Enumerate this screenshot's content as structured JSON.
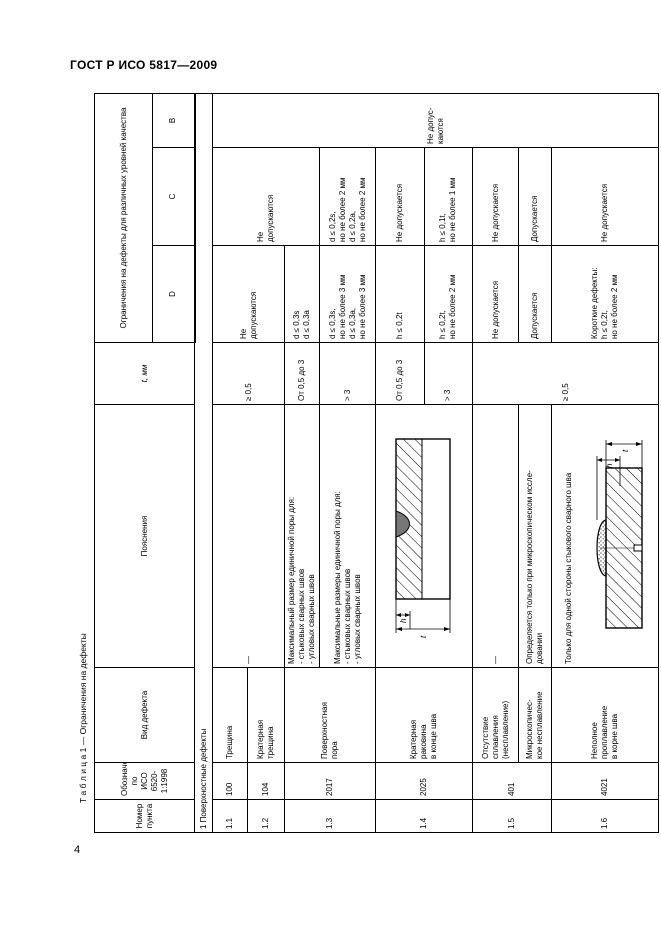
{
  "page": {
    "doc_code": "ГОСТ Р ИСО 5817—2009",
    "page_number": "4",
    "colors": {
      "text": "#000000",
      "background": "#ffffff",
      "border": "#000000",
      "crater_fill": "#777777"
    }
  },
  "caption": "Т а б л и ц а  1 — Ограничения на дефекты",
  "headers": {
    "num": "Номер\nпункта",
    "ref": "Обозначение по\nИСО 6520-1:1998",
    "type": "Вид дефекта",
    "note": "Пояснения",
    "t": "t, мм",
    "limits": "Ограничения на дефекты для различных уровней качества",
    "level_d": "D",
    "level_c": "C",
    "level_b": "B"
  },
  "section1": "1 Поверхностные дефекты",
  "cells": {
    "r11_num": "1.1",
    "r11_ref": "100",
    "r11_type": "Трещина",
    "r12_num": "1.2",
    "r12_ref": "104",
    "r12_type": "Кратерная\nтрещина",
    "r11_12_note": "—",
    "r11_12_t": "≥ 0,5",
    "r11_12_d": "Не\nдопускаются",
    "c_merge_11_13a": "Не\nдопускаются",
    "b_merge_all": "Не допус-каются",
    "r13_num": "1.3",
    "r13_ref": "2017",
    "r13_type": "Поверхностная\nпора",
    "r13a_note": "Максимальный размер единичной поры для:\n- стыковых сварных швов\n- угловых сварных швов",
    "r13a_t": "От 0,5 до 3",
    "r13a_d": "d ≤ 0,3s\nd ≤ 0,3a",
    "r13b_note": "Максимальные размеры единичной поры для:\n- стыковых сварных швов\n- угловых сварных швов",
    "r13b_t": "> 3",
    "r13b_d": "d ≤ 0,3s,\nно не более 3 мм\nd ≤ 0,3a,\nно не более 3 мм",
    "r13b_c": "d ≤ 0,2s,\nно не более 2 мм\nd ≤ 0,2a,\nно не более 2 мм",
    "r14_num": "1.4",
    "r14_ref": "2025",
    "r14_type": "Кратерная\nраковина\nв конце шва",
    "r14a_t": "От 0,5 до 3",
    "r14a_d": "h ≤ 0,2t",
    "r14a_c": "Не допускается",
    "r14b_t": "> 3",
    "r14b_d": "h ≤ 0,2t,\nно не более 2 мм",
    "r14b_c": "h ≤ 0,1t,\nно не более 1 мм",
    "r15_num": "1.5",
    "r15_ref": "401",
    "r15a_type": "Отсутствие\nсплавления\n(несплавление)",
    "r15a_note": "—",
    "r15a_d": "Не допускается",
    "r15a_c": "Не допускается",
    "r15b_type": "Микроскопичес-\nкое несплавление",
    "r15b_note": "Определяется только при микроскопическом иссле-\nдовании",
    "r15b_d": "Допускается",
    "r15b_c": "Допускается",
    "r15_16_t": "≥ 0,5",
    "r16_num": "1.6",
    "r16_ref": "4021",
    "r16_type": "Неполное\nпроплавление\nв корне шва",
    "r16_note_text": "Только для одной стороны стыкового сварного шва",
    "r16_d": "Короткие дефекты:\nh ≤ 0,2t,\nно не более 2 мм",
    "r16_c": "Не допускается"
  },
  "diagrams": {
    "crater": {
      "h_label": "h",
      "t_label": "t"
    },
    "root": {
      "h_label": "h",
      "t_label": "t"
    }
  }
}
